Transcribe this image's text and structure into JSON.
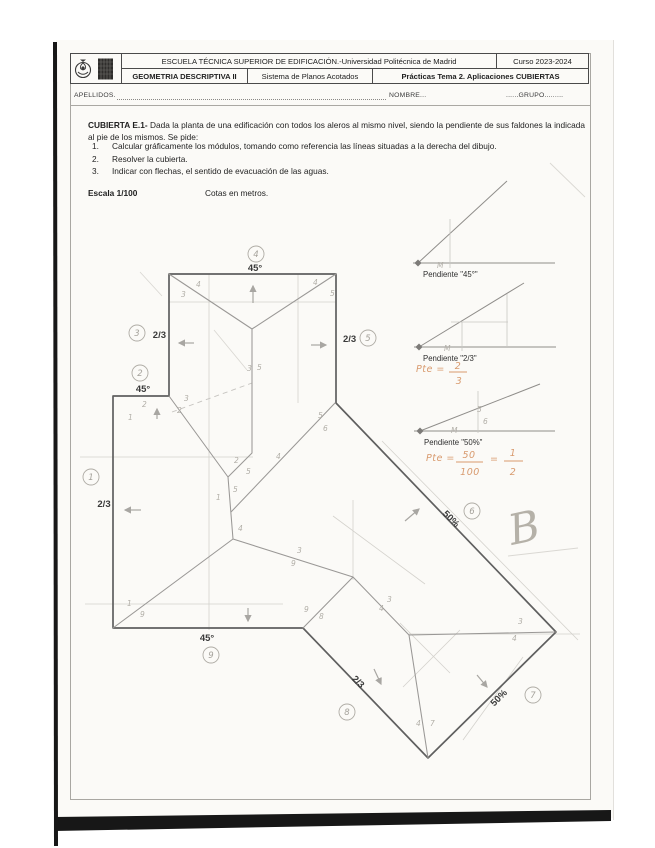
{
  "header": {
    "school": "ESCUELA TÉCNICA SUPERIOR DE EDIFICACIÓN.-Universidad Politécnica de Madrid",
    "curso": "Curso 2023-2024",
    "subject": "GEOMETRIA DESCRIPTIVA II",
    "system": "Sistema de Planos Acotados",
    "practice": "Prácticas Tema 2. Aplicaciones CUBIERTAS"
  },
  "form": {
    "apellidos": "APELLIDOS.",
    "nombre": "NOMBRE...",
    "grupo": "......GRUPO........."
  },
  "exercise": {
    "title_bold": "CUBIERTA E.1-",
    "intro_rest": " Dada la planta de una edificación con todos los aleros al mismo nivel, siendo la pendiente de sus faldones la indicada al pie de los mismos. Se pide:",
    "items": [
      {
        "num": "1.",
        "text": "Calcular gráficamente los módulos, tomando como referencia las líneas situadas a la derecha del dibujo."
      },
      {
        "num": "2.",
        "text": "Resolver la cubierta."
      },
      {
        "num": "3.",
        "text": "Indicar con flechas, el sentido de evacuación de las aguas."
      }
    ],
    "scale_bold": "Escala 1/100",
    "units": "Cotas en metros."
  },
  "drawing": {
    "slope_labels": [
      {
        "t": "45°",
        "x": 255,
        "y": 271,
        "a": "middle"
      },
      {
        "t": "2/3",
        "x": 166,
        "y": 338,
        "a": "end"
      },
      {
        "t": "2/3",
        "x": 343,
        "y": 342,
        "a": "start"
      },
      {
        "t": "45°",
        "x": 143,
        "y": 392,
        "a": "middle"
      },
      {
        "t": "2/3",
        "x": 104,
        "y": 507,
        "a": "middle"
      },
      {
        "t": "45°",
        "x": 207,
        "y": 641,
        "a": "middle"
      },
      {
        "t": "50%",
        "x": 449,
        "y": 521,
        "a": "middle",
        "r": 45
      },
      {
        "t": "50%",
        "x": 501,
        "y": 700,
        "a": "middle",
        "r": -45
      },
      {
        "t": "2/3",
        "x": 356,
        "y": 684,
        "a": "middle",
        "r": 45
      }
    ],
    "circled": [
      {
        "n": "1",
        "x": 91,
        "y": 477
      },
      {
        "n": "2",
        "x": 140,
        "y": 373
      },
      {
        "n": "3",
        "x": 137,
        "y": 333
      },
      {
        "n": "4",
        "x": 256,
        "y": 254
      },
      {
        "n": "5",
        "x": 368,
        "y": 338
      },
      {
        "n": "6",
        "x": 472,
        "y": 511
      },
      {
        "n": "7",
        "x": 533,
        "y": 695
      },
      {
        "n": "8",
        "x": 347,
        "y": 712
      },
      {
        "n": "9",
        "x": 211,
        "y": 655
      }
    ],
    "marks": [
      {
        "t": "3",
        "x": 181,
        "y": 297
      },
      {
        "t": "4",
        "x": 196,
        "y": 287
      },
      {
        "t": "4",
        "x": 313,
        "y": 285
      },
      {
        "t": "5",
        "x": 330,
        "y": 296
      },
      {
        "t": "3",
        "x": 247,
        "y": 371
      },
      {
        "t": "5",
        "x": 257,
        "y": 370
      },
      {
        "t": "1",
        "x": 128,
        "y": 420
      },
      {
        "t": "2",
        "x": 142,
        "y": 407
      },
      {
        "t": "2",
        "x": 177,
        "y": 413
      },
      {
        "t": "3",
        "x": 184,
        "y": 401
      },
      {
        "t": "1",
        "x": 216,
        "y": 500
      },
      {
        "t": "4",
        "x": 238,
        "y": 531
      },
      {
        "t": "2",
        "x": 234,
        "y": 463
      },
      {
        "t": "5",
        "x": 233,
        "y": 492
      },
      {
        "t": "5",
        "x": 246,
        "y": 474
      },
      {
        "t": "4",
        "x": 276,
        "y": 459
      },
      {
        "t": "5",
        "x": 318,
        "y": 418
      },
      {
        "t": "6",
        "x": 323,
        "y": 431
      },
      {
        "t": "3",
        "x": 297,
        "y": 553
      },
      {
        "t": "9",
        "x": 291,
        "y": 566
      },
      {
        "t": "5",
        "x": 477,
        "y": 412
      },
      {
        "t": "6",
        "x": 483,
        "y": 424
      },
      {
        "t": "3",
        "x": 387,
        "y": 602
      },
      {
        "t": "4",
        "x": 379,
        "y": 611
      },
      {
        "t": "3",
        "x": 518,
        "y": 624
      },
      {
        "t": "4",
        "x": 512,
        "y": 641
      },
      {
        "t": "4",
        "x": 416,
        "y": 726
      },
      {
        "t": "7",
        "x": 430,
        "y": 726
      },
      {
        "t": "1",
        "x": 127,
        "y": 606
      },
      {
        "t": "9",
        "x": 140,
        "y": 617
      },
      {
        "t": "9",
        "x": 304,
        "y": 612
      },
      {
        "t": "8",
        "x": 319,
        "y": 619
      },
      {
        "t": "M",
        "x": 437,
        "y": 268
      },
      {
        "t": "M",
        "x": 444,
        "y": 351
      },
      {
        "t": "M",
        "x": 451,
        "y": 433
      }
    ],
    "reference": {
      "d1_label": "Pendiente \"45°\"",
      "d2_label": "Pendiente \"2/3\"",
      "d3_label": "Pendiente \"50%\""
    },
    "notes": {
      "pte2_prefix": "Pte =",
      "pte2_num": "2",
      "pte2_den": "3",
      "pte50_prefix": "Pte =",
      "pte50_num": "50",
      "pte50_den": "100",
      "pte50_eq": "=",
      "pte50_num2": "1",
      "pte50_den2": "2",
      "b_mark": "B"
    }
  }
}
